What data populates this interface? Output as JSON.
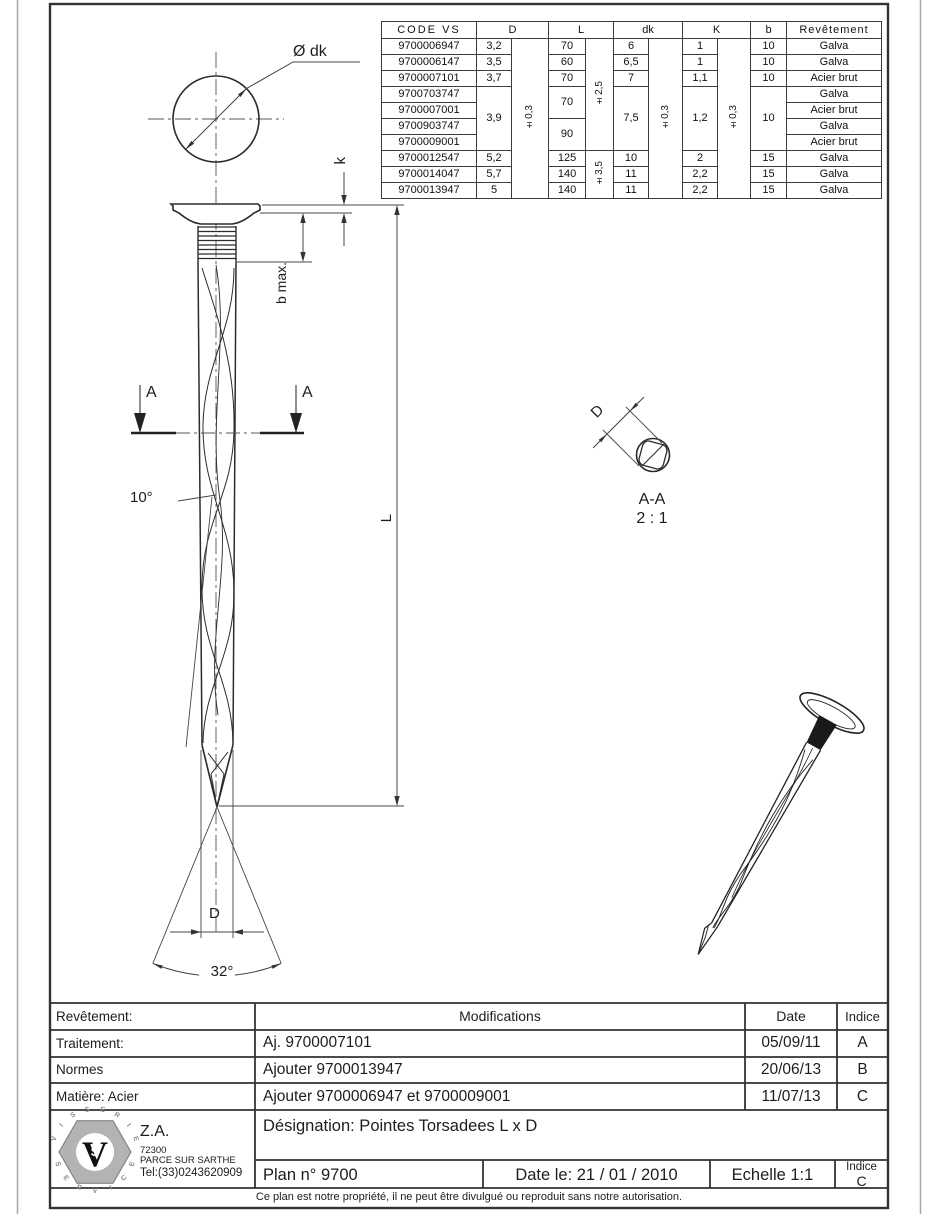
{
  "spec_table": {
    "headers": {
      "code": "CODE VS",
      "d": "D",
      "l": "L",
      "dk": "dk",
      "k": "K",
      "b": "b",
      "coating": "Revêtement"
    },
    "tolerances": {
      "d": "±0,3",
      "l_top": "±2,5",
      "l_bottom": "±3,5",
      "dk": "±0,3",
      "k": "±0,3"
    },
    "rows": [
      {
        "code": "9700006947",
        "d": "3,2",
        "l": "70",
        "dk": "6",
        "k": "1",
        "b": "10",
        "coating": "Galva"
      },
      {
        "code": "9700006147",
        "d": "3,5",
        "l": "60",
        "dk": "6,5",
        "k": "1",
        "b": "10",
        "coating": "Galva"
      },
      {
        "code": "9700007101",
        "d": "3,7",
        "l": "70",
        "dk": "7",
        "k": "1,1",
        "b": "10",
        "coating": "Acier brut"
      },
      {
        "code": "9700703747",
        "d": "3,9",
        "l": "70",
        "dk": "7,5",
        "k": "1,2",
        "b": "10",
        "coating": "Galva"
      },
      {
        "code": "9700007001",
        "coating": "Acier brut"
      },
      {
        "code": "9700903747",
        "l": "90",
        "coating": "Galva"
      },
      {
        "code": "9700009001",
        "coating": "Acier brut"
      },
      {
        "code": "9700012547",
        "d": "5,2",
        "l": "125",
        "dk": "10",
        "k": "2",
        "b": "15",
        "coating": "Galva"
      },
      {
        "code": "9700014047",
        "d": "5,7",
        "l": "140",
        "dk": "11",
        "k": "2,2",
        "b": "15",
        "coating": "Galva"
      },
      {
        "code": "9700013947",
        "d": "5",
        "l": "140",
        "dk": "11",
        "k": "2,2",
        "b": "15",
        "coating": "Galva"
      }
    ]
  },
  "drawing": {
    "labels": {
      "head_dia": "Ø dk",
      "head_height": "k",
      "ridge_len": "b max.",
      "section_mark": "A",
      "twist_angle": "10°",
      "length": "L",
      "dia": "D",
      "tip_angle": "32°",
      "section_dia": "D",
      "section_name": "A-A",
      "section_scale": "2 : 1"
    }
  },
  "title_block": {
    "left_rows": [
      "Revêtement:",
      "Traitement:",
      "Normes",
      "Matière: Acier"
    ],
    "mod_header": "Modifications",
    "date_header": "Date",
    "indice_header": "Indice",
    "revisions": [
      {
        "text": "Aj. 9700007101",
        "date": "05/09/11",
        "indice": "A"
      },
      {
        "text": "Ajouter 9700013947",
        "date": "20/06/13",
        "indice": "B"
      },
      {
        "text": "Ajouter 9700006947 et 9700009001",
        "date": "11/07/13",
        "indice": "C"
      }
    ],
    "designation": "Désignation: Pointes Torsadees L x D",
    "plan": "Plan n° 9700",
    "date": "Date le: 21 / 01 / 2010",
    "scale": "Echelle 1:1",
    "indice_label": "Indice",
    "indice_value": "C",
    "company": {
      "za": "Z.A.",
      "zip": "72300",
      "city": "PARCE SUR SARTHE",
      "tel": "Tel:(33)0243620909",
      "logo_top": "VISSERIE",
      "logo_bottom": "SERVICE",
      "monogram_v": "V",
      "monogram_s": "S"
    }
  },
  "footer_note": "Ce plan est notre propriété, il ne peut être divulgué ou reproduit sans notre autorisation."
}
